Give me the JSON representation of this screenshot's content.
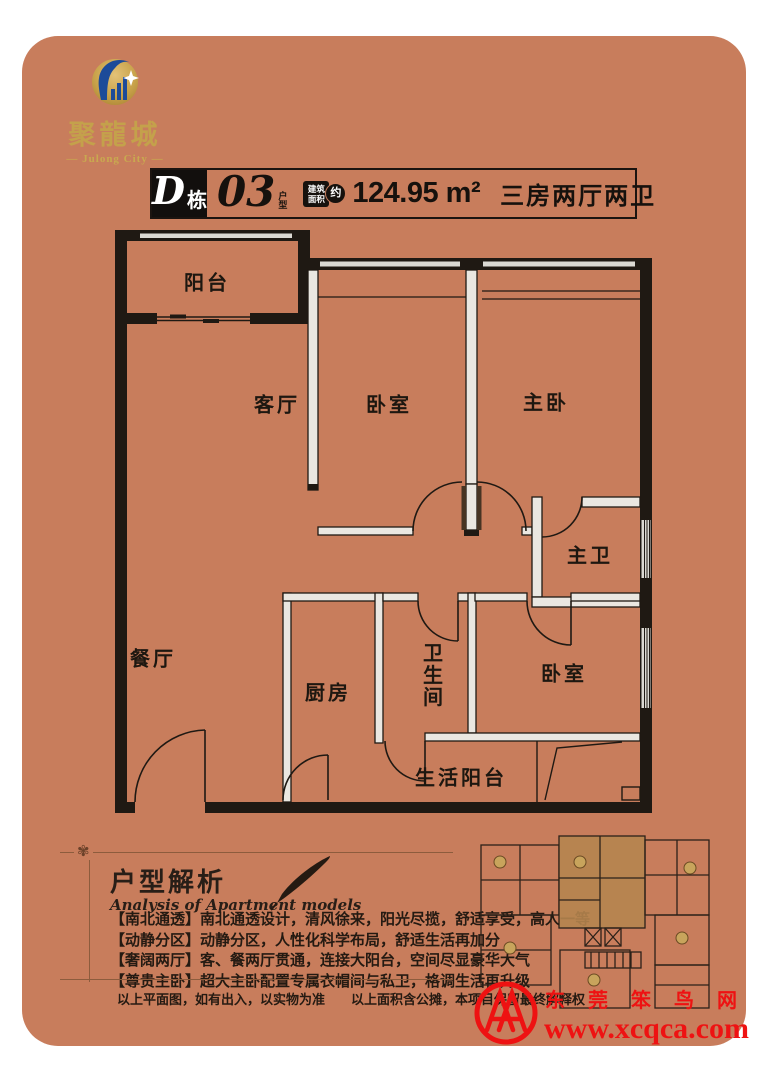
{
  "brand": {
    "logo_cn": "聚龍城",
    "logo_en": "— Julong City —"
  },
  "header": {
    "building": "D",
    "building_suffix": "栋",
    "unit": "03",
    "unit_suffix_1": "户",
    "unit_suffix_2": "型",
    "badge_line1": "建筑",
    "badge_line2": "面积",
    "badge_circle": "约",
    "area": "124.95 m²",
    "layout": "三房两厅两卫"
  },
  "floorplan": {
    "rooms": [
      {
        "label": "阳台"
      },
      {
        "label": "客厅"
      },
      {
        "label": "卧室"
      },
      {
        "label": "主卧"
      },
      {
        "label": "主卫"
      },
      {
        "label": "餐厅"
      },
      {
        "label": "厨房"
      },
      {
        "label": "卫生间"
      },
      {
        "label": "卧室"
      },
      {
        "label": "生活阳台"
      }
    ]
  },
  "analysis": {
    "ornament": "✾",
    "title": "户型解析",
    "subtitle": "Analysis of Apartment models",
    "bullets": [
      "【南北通透】南北通透设计，清风徐来，阳光尽揽，舒适享受，高人一等",
      "【动静分区】动静分区，人性化科学布局，舒适生活再加分",
      "【奢阔两厅】客、餐两厅贯通，连接大阳台，空间尽显豪华大气",
      "【尊贵主卧】超大主卧配置专属衣帽间与私卫，格调生活再升级"
    ]
  },
  "disclaimer": {
    "left": "以上平面图，如有出入，以实物为准",
    "right": "以上面积含公摊，本项目保留最终解释权"
  },
  "watermark": {
    "name": "东莞笨鸟网",
    "url": "www.xcqca.com"
  },
  "colors": {
    "card_bg": "#c87d5c",
    "gold": "#c4a14b",
    "wall_black": "#1f1913",
    "thin_wall": "#eae7e1",
    "highlight_unit": "#b5854f",
    "line_brown": "#8d5c3d",
    "watermark_red": "#ee1212"
  }
}
